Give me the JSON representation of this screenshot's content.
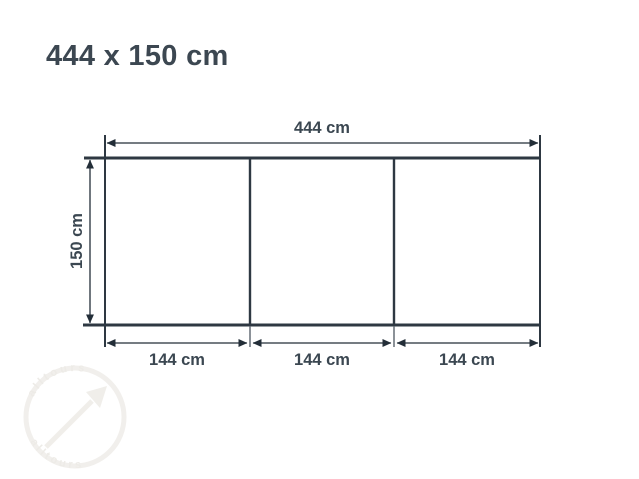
{
  "title": "444 x 150 cm",
  "diagram": {
    "total_width_label": "444 cm",
    "height_label": "150 cm",
    "panel_labels": [
      "144 cm",
      "144 cm",
      "144 cm"
    ],
    "panel_count": 3
  },
  "watermark": {
    "text_top": "alltours",
    "text_bottom": "alltours"
  },
  "colors": {
    "text": "#3b4751",
    "board_line": "#2e3842",
    "dimension_line": "#232e38",
    "watermark": "#f0eeeb"
  }
}
